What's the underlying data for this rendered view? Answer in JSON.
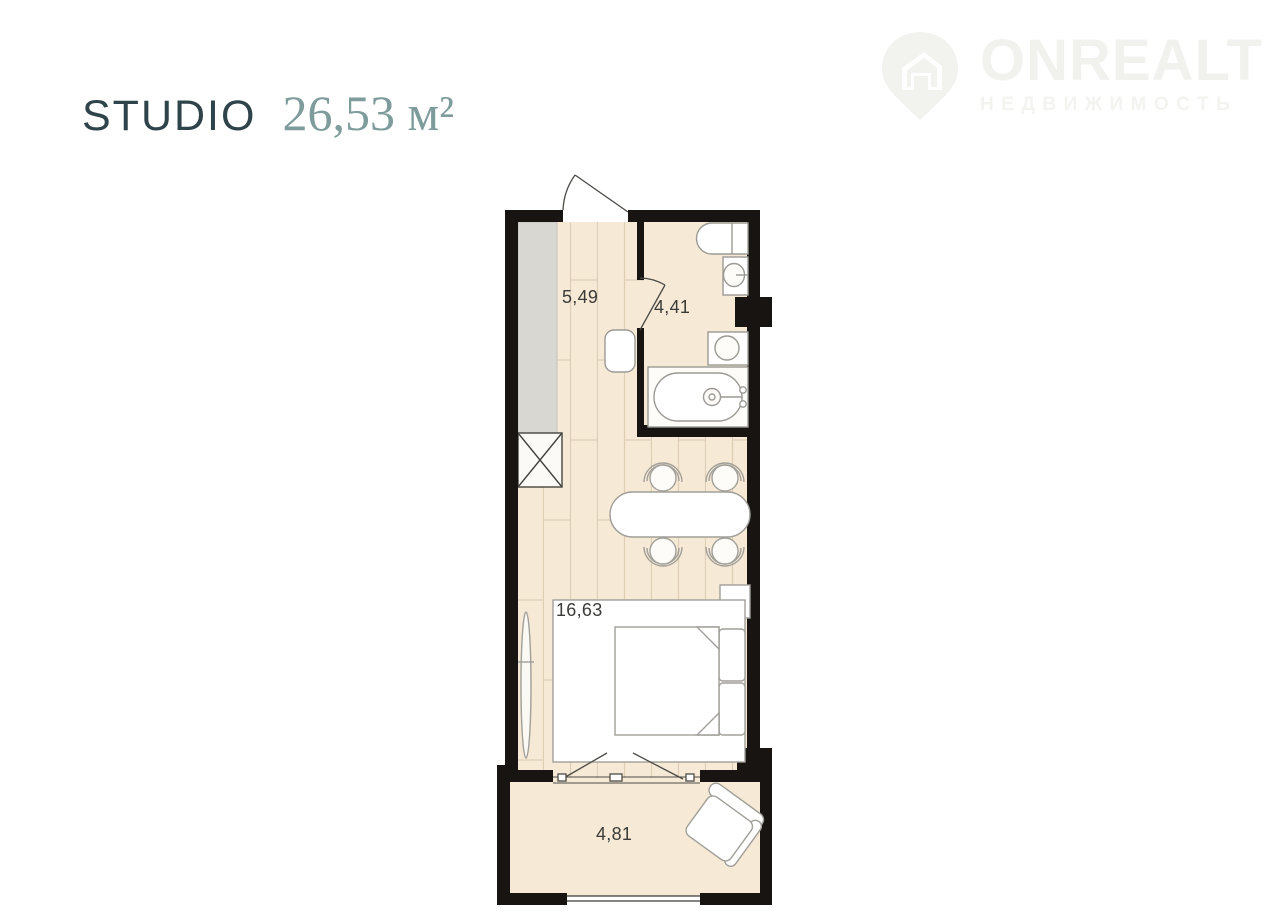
{
  "header": {
    "plan_type": "STUDIO",
    "area_value": "26,53 м²"
  },
  "logo": {
    "brand": "ONREALT",
    "tagline": "НЕДВИЖИМОСТЬ",
    "icon": "house-pin-icon"
  },
  "floor_plan": {
    "total_area_m2": "26,53",
    "rooms": [
      {
        "id": "hallway",
        "area_label": "5,49"
      },
      {
        "id": "bathroom",
        "area_label": "4,41"
      },
      {
        "id": "living-room",
        "area_label": "16,63"
      },
      {
        "id": "balcony",
        "area_label": "4,81"
      }
    ],
    "fixtures": [
      "wardrobe",
      "crossed-closet",
      "entry-door",
      "bathroom-door",
      "toilet",
      "washbasin",
      "washing-machine",
      "bathtub",
      "shaft",
      "stool",
      "dining-table",
      "chairs",
      "nightstand",
      "bed",
      "pillows",
      "mirror",
      "balcony-doors",
      "balcony-window",
      "armchair"
    ],
    "colors": {
      "wall": "#171412",
      "floor": "#f6e9d5",
      "plank_line": "#ddceb5",
      "wardrobe_gray": "#d8d7d1",
      "fixture_outline": "#9b9a94",
      "title": "#2e444a",
      "area_accent": "#7d9c9b",
      "watermark": "#f1f1ee"
    }
  }
}
